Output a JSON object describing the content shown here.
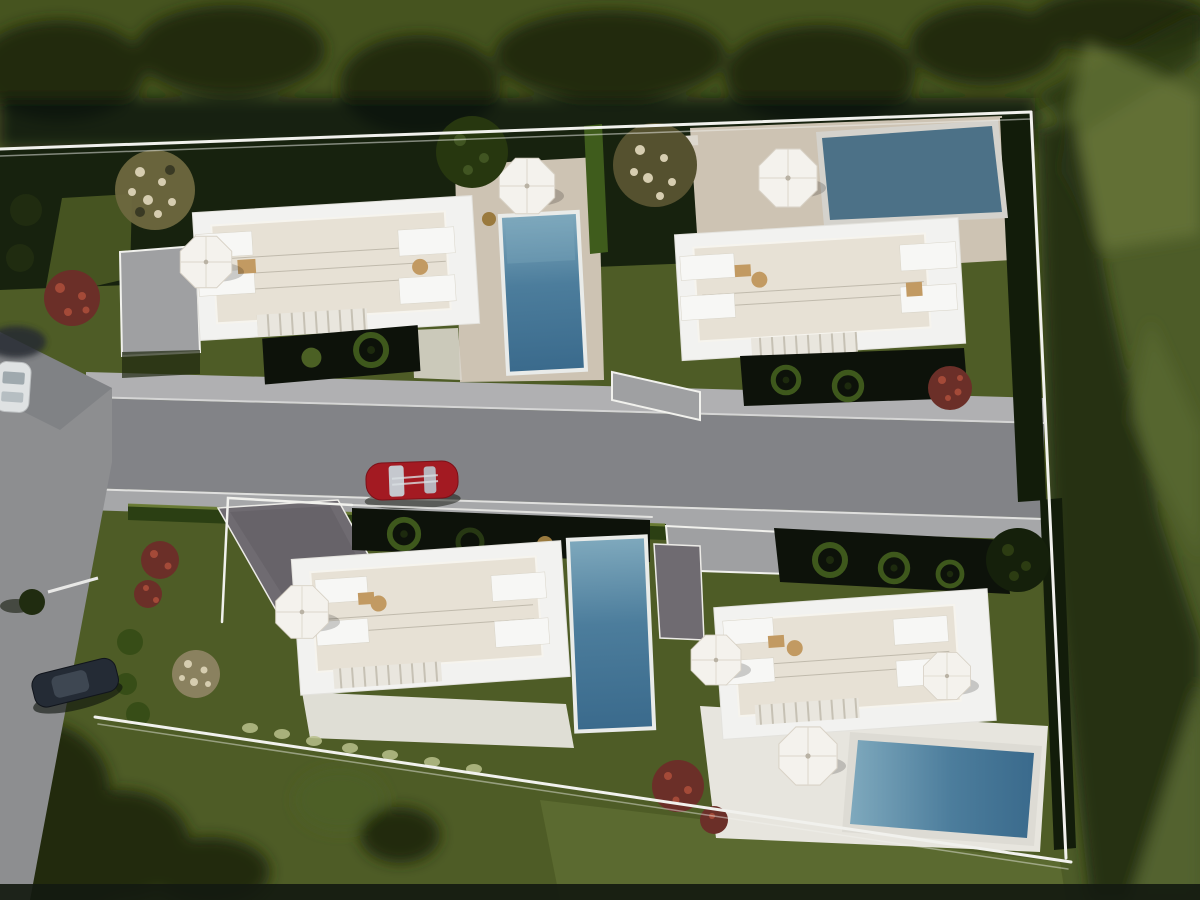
{
  "scene": {
    "type": "aerial architectural 3D render",
    "description": "Top-down daytime rendering of a residential development: four modern white flat-roof villas on a walled plot, each with rooftop terraces, white sun parasols, lounge furniture and a private blue swimming pool. A grey access road with a red sports car crosses the middle, a vertical side street with a white car and a dark car runs along the left edge, and the plot is surrounded by lawns, dark hedges, trees, red and white flowering shrubs."
  },
  "colors": {
    "grass_base": "#4e5c26",
    "grass_top": "#46541f",
    "grass_right": "#4d5c28",
    "grass_bright": "#68773a",
    "shadow_green": "#26330f",
    "tree_dark": "#202c10",
    "tree_light": "#4b6024",
    "hedge_dark": "#121c0a",
    "hedge_body": "#2b3f13",
    "hedge_bright": "#6f8138",
    "patio_dark": "#0d120a",
    "ring_green": "#3e581c",
    "ring_core": "#1d2a0e",
    "boundary_white": "#f1f1ed",
    "road_gray": "#828387",
    "road_light": "#a6a7a9",
    "sidewalk": "#b0b0b2",
    "street_gray": "#8d8e90",
    "slab_gray": "#9fa0a2",
    "villa_white": "#f2f2f0",
    "roof_warm": "#e7e1d5",
    "roof_line": "#b3ad9f",
    "gray_roof": "#6f6b71",
    "deck_beige": "#cdc3b3",
    "apron_white": "#e7e5de",
    "pool_light": "#7fa9bd",
    "pool_mid": "#4c7d9c",
    "pool_deep": "#3a6a8c",
    "pool_flat": "#4c7187",
    "pool_coping": "#e9ebe9",
    "parasol_white": "#f4f2ed",
    "parasol_shade": "#d8d2c6",
    "furn_white": "#f7f7f5",
    "tan": "#c29a62",
    "stone_dot": "#b9c08b",
    "bush_red": "#6b2f28",
    "bush_red_hi": "#a44a38",
    "bush_cream": "#d6cdb0",
    "bush_cream_base": "#8a815f",
    "car_red": "#a31a22",
    "car_glass": "#c7d2d8",
    "car_dark": "#242b35",
    "car_white": "#dfe2e3",
    "edge_dark": "#141a10",
    "bronze": "#9a7a3e"
  },
  "objects": {
    "villas": [
      {
        "id": "villa-top-left",
        "pool": "vertical pool on east side of lot",
        "parasols": 2
      },
      {
        "id": "villa-top-right",
        "pool": "wide pool at north-east corner",
        "parasols": 2
      },
      {
        "id": "villa-bottom-left",
        "pool": "vertical pool on east side of lot",
        "parasols": 1
      },
      {
        "id": "villa-bottom-right",
        "pool": "wide pool on south side",
        "parasols": 3
      }
    ],
    "vehicles": [
      {
        "id": "red-sports-car",
        "color_key": "car_red",
        "location": "central access road"
      },
      {
        "id": "white-car",
        "color_key": "car_white",
        "location": "left street, top"
      },
      {
        "id": "dark-car",
        "color_key": "car_dark",
        "location": "left street, bottom"
      }
    ],
    "landscape": [
      "lawns",
      "boundary hedges",
      "ornamental ring planters",
      "red flowering shrubs",
      "white flowering shrubs",
      "trees",
      "stepping stones"
    ]
  }
}
